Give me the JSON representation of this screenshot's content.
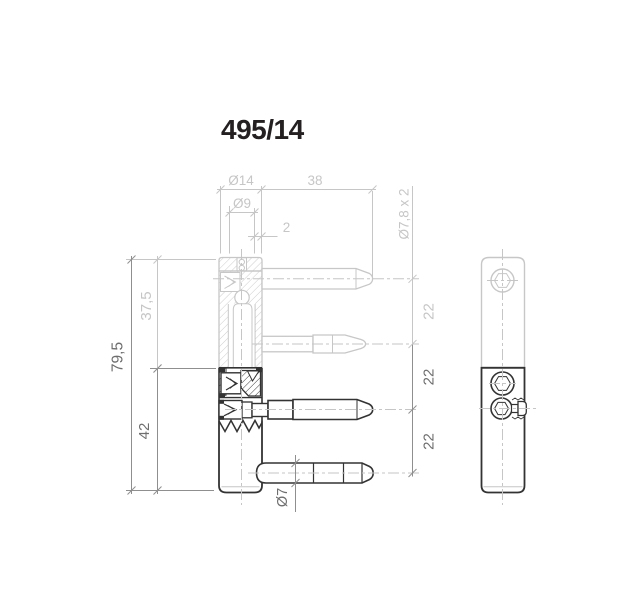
{
  "title": "495/14",
  "drawing_type": "hinge-technical-drawing",
  "views": {
    "front": "front-section-view",
    "side": "side-view"
  },
  "dimensions": {
    "dia_head": "Ø14",
    "pin_length": "38",
    "dia_inner": "Ø9",
    "offset": "2",
    "dia_frame_pins": "Ø7,8 x 2",
    "total_height": "79,5",
    "frame_part_height": "37,5",
    "leaf_part_height": "42",
    "pin_spacing_top": "22",
    "pin_spacing_mid": "22",
    "pin_spacing_bottom": "22",
    "dia_bottom_pin": "Ø7"
  },
  "colors": {
    "part_light": "#c7c7c7",
    "part_dark": "#333333",
    "dim_light": "#c6c6c6",
    "dim_dark": "#8f8f8f",
    "label_dark": "#6e6e6e",
    "title_color": "#242021",
    "bg": "#ffffff"
  }
}
